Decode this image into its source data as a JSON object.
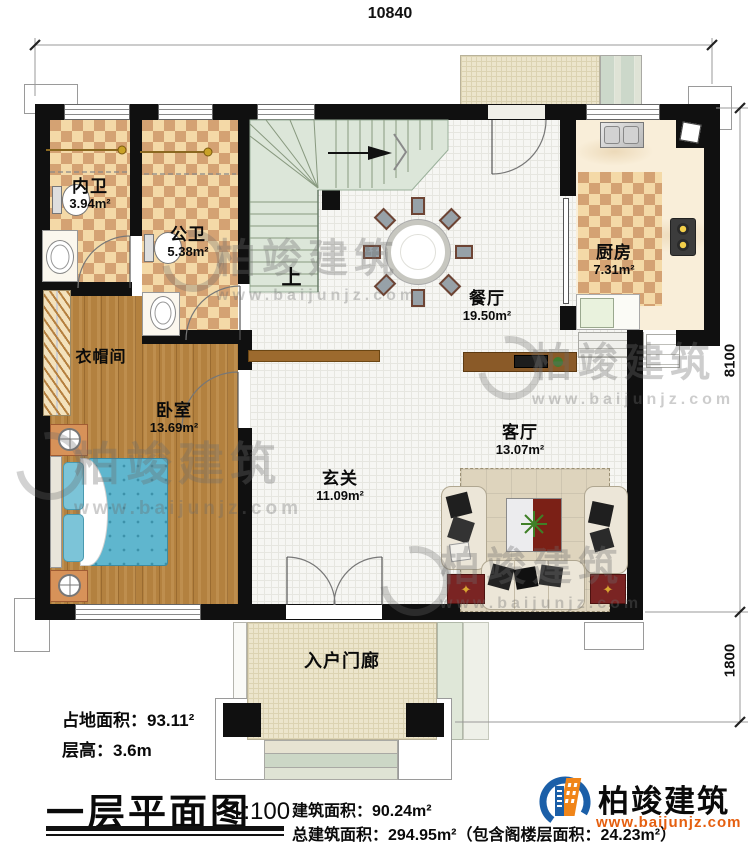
{
  "dimensions": {
    "top": "10840",
    "right_upper": "8100",
    "right_lower": "1800"
  },
  "rooms": {
    "inner_bath": {
      "name": "内卫",
      "area": "3.94m²"
    },
    "public_bath": {
      "name": "公卫",
      "area": "5.38m²"
    },
    "kitchen": {
      "name": "厨房",
      "area": "7.31m²"
    },
    "dining": {
      "name": "餐厅",
      "area": "19.50m²"
    },
    "cloakroom": {
      "name": "衣帽间"
    },
    "bedroom": {
      "name": "卧室",
      "area": "13.69m²"
    },
    "living": {
      "name": "客厅",
      "area": "13.07m²"
    },
    "foyer": {
      "name": "玄关",
      "area": "11.09m²"
    },
    "porch": {
      "name": "入户门廊"
    },
    "stair_up": "上"
  },
  "footer": {
    "land_area": "占地面积：93.11²",
    "floor_height": "层高：3.6m",
    "title": "一层平面图",
    "scale": "1:100",
    "building_area": "建筑面积：90.24m²",
    "total_area": "总建筑面积：294.95m²（包含阁楼层面积：24.23m²）"
  },
  "brand": {
    "name": "柏竣建筑",
    "site": "www.baijunjz.com"
  },
  "watermark": {
    "name": "柏竣建筑",
    "site": "www.baijunjz.com"
  },
  "colors": {
    "wall": "#101010",
    "checker_light": "#f4d9a7",
    "checker_dark": "#d4a273",
    "wood": "#b3813f",
    "stair": "#dce6d9",
    "bed_teal": "#5fb6ce",
    "sofa_cream": "#ece6d8",
    "table_red": "#7b2016",
    "logo_blue": "#1b5fa8",
    "logo_orange": "#f08519",
    "site_orange": "#e55f0f"
  }
}
